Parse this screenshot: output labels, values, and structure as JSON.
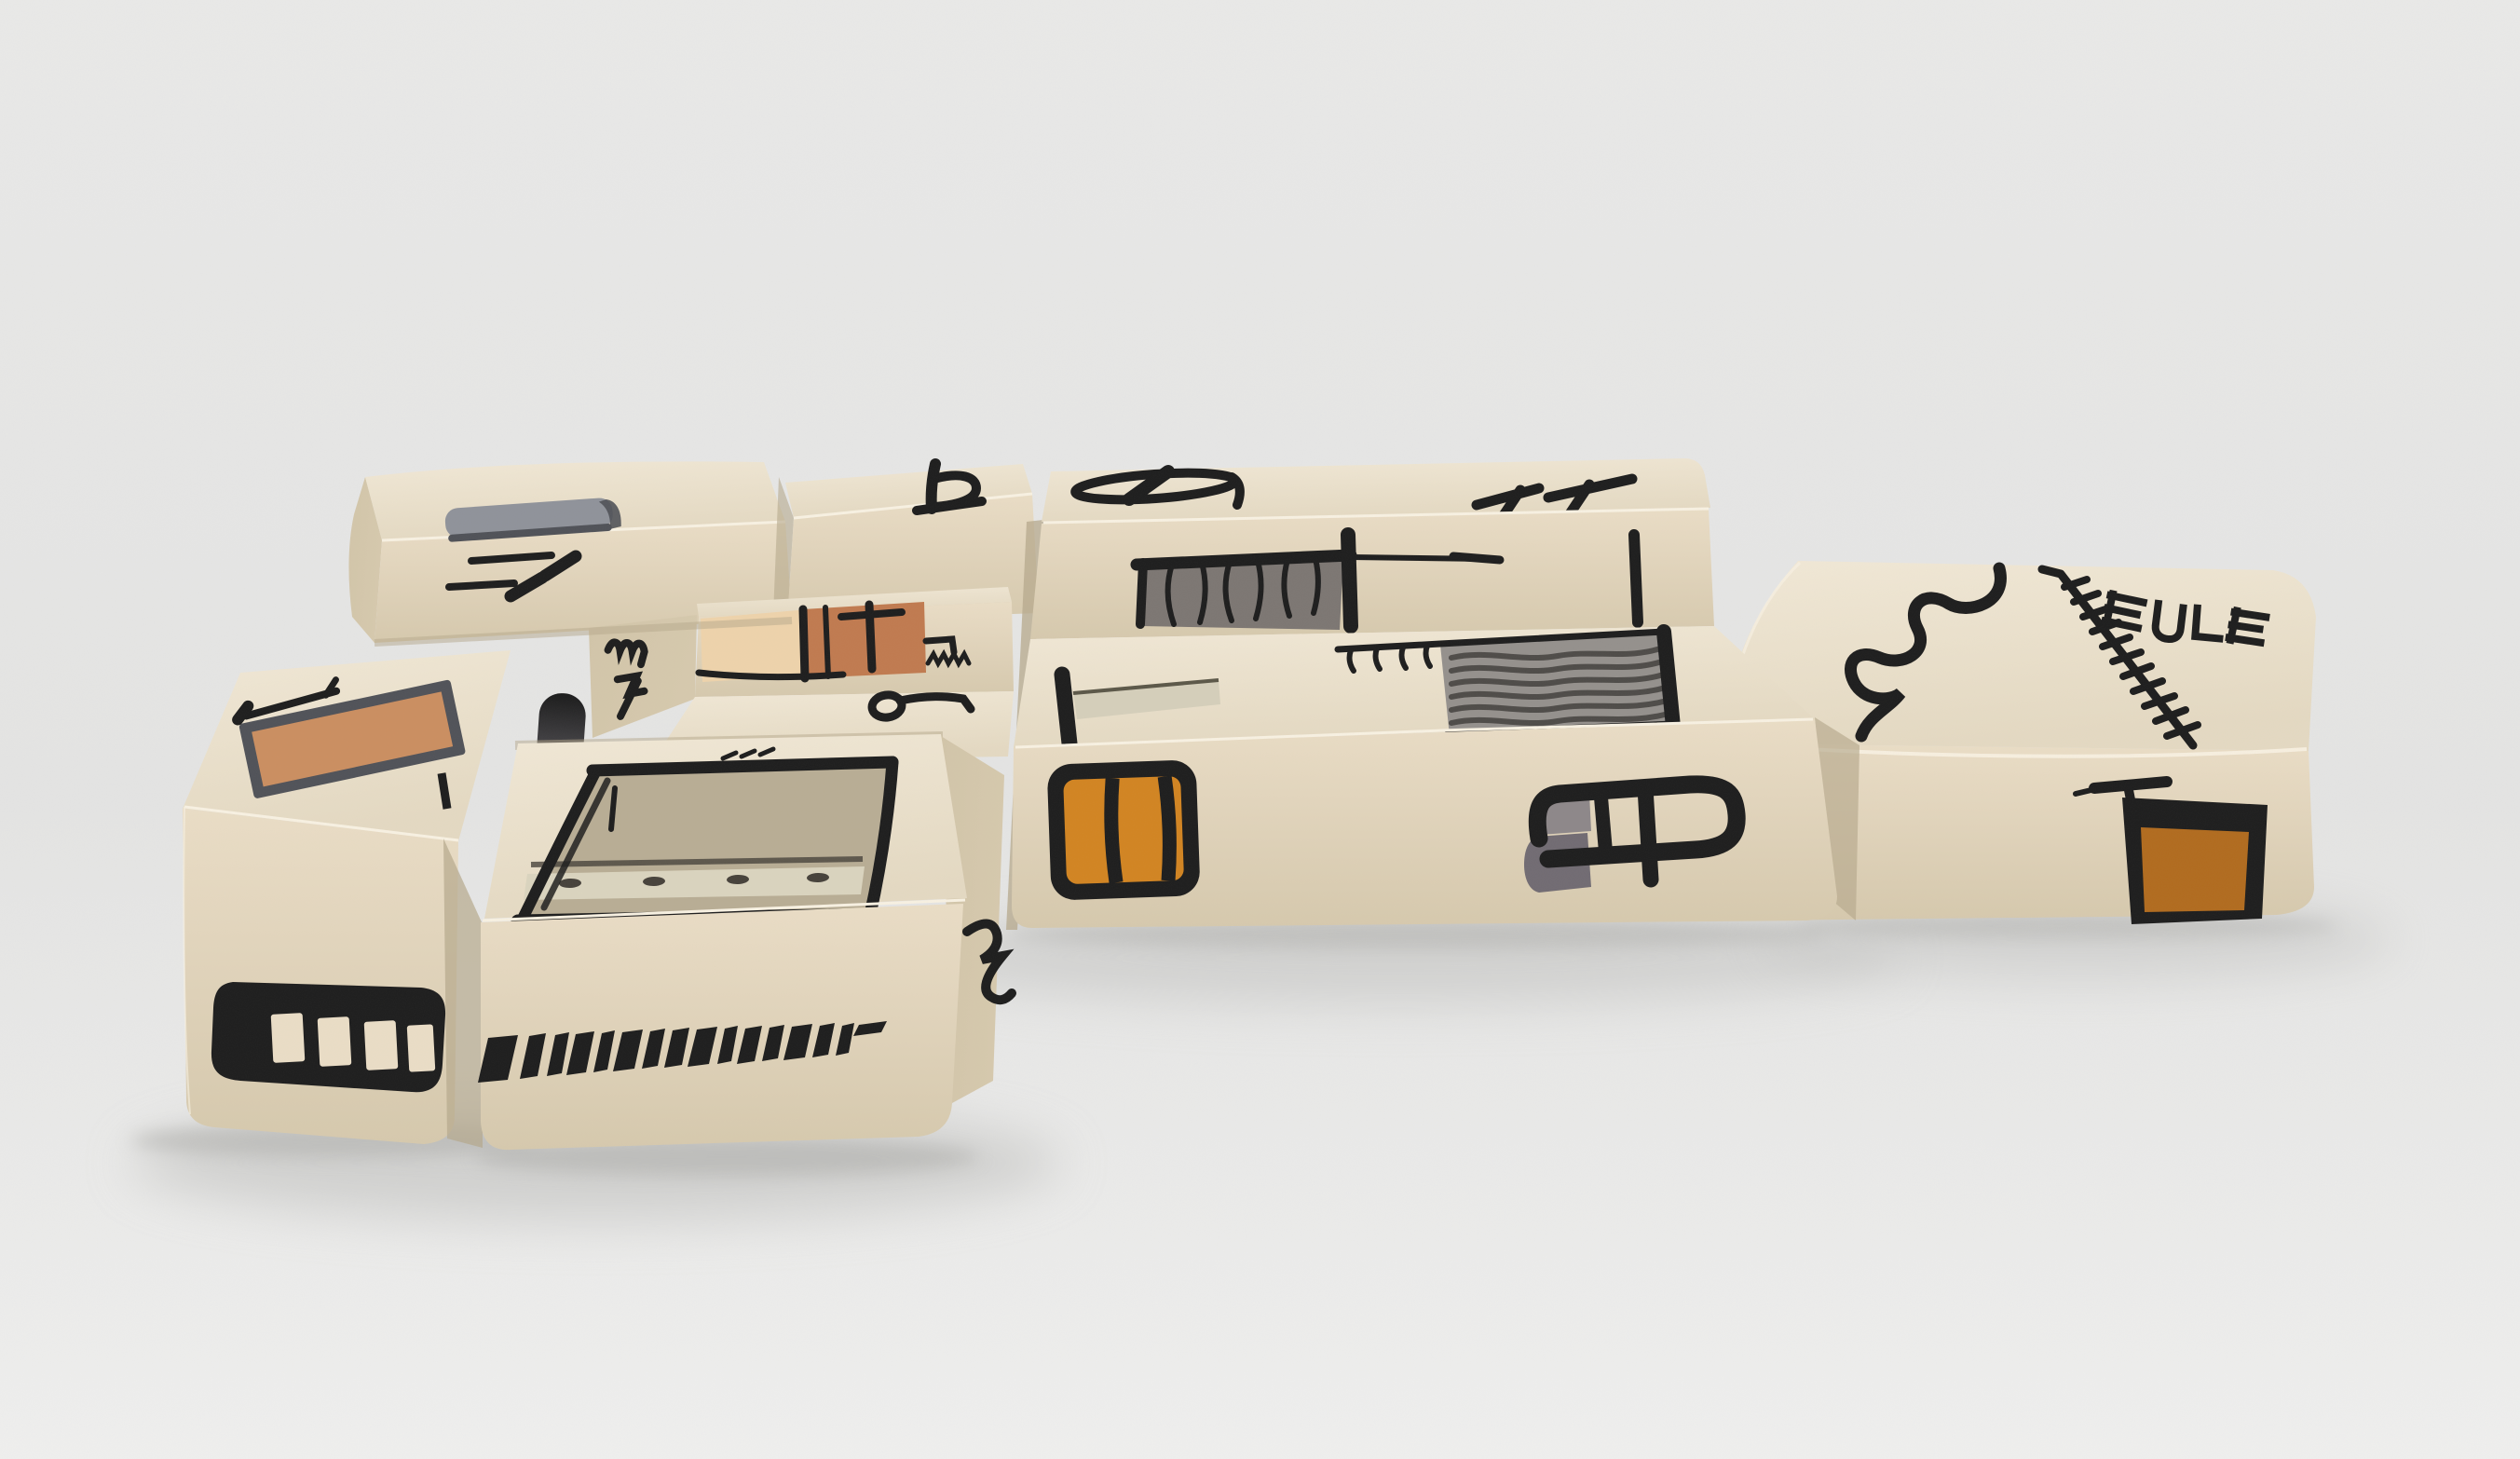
{
  "scene": {
    "description": "Studio product photo of a cream modular fabric sofa printed with abstract black, gray, orange and terracotta doodle motifs, on a plain light gray background",
    "caption": ""
  },
  "palette": {
    "background_top": "#e9e9e8",
    "background": "#e4e4e3",
    "floor_light": "#efefee",
    "shadow_soft": "#bdbdbb",
    "shadow_contact": "#a9a9a6",
    "fabric_top": "#f1e8d6",
    "fabric_top_deep": "#e4d9c2",
    "fabric_front": "#eaddc6",
    "fabric_front_deep": "#d6c9ad",
    "fabric_shade": "#d2c5a9",
    "fabric_deep": "#b5a88c",
    "piping": "#f8f1e2",
    "ink": "#1d1d1d",
    "band_gray": "#8f929a",
    "band_gray_dark": "#4f5157",
    "curtain_gray": "#7c7672",
    "woven_gray": "#94908c",
    "woven_line": "#4e4b48",
    "taupe": "#b8ad94",
    "taupe_band": "#dad4be",
    "taupe_line": "#46413a",
    "beige_bar": "#d5cfba",
    "beige_bar_edge": "#5b5748",
    "orange": "#d28421",
    "pocket_orange": "#b16b1e",
    "tan_patch": "#cb8e60",
    "tan_frame": "#505258",
    "terracotta": "#c07a4f",
    "peach": "#eed3ab",
    "glyph_gray": "#8d8789",
    "glyph_gray_dark": "#716b72",
    "zip_dark": "#1a1a1a",
    "zip_light": "#76737a"
  },
  "sofa": {
    "modules": [
      {
        "id": "left-arm-bench",
        "motifs": [
          "tan-framed-patch",
          "hammer-glyph",
          "film-strip",
          "edge-tick"
        ]
      },
      {
        "id": "left-backrest",
        "motifs": [
          "gray-wrap-band",
          "check-strokes",
          "zip-bar"
        ]
      },
      {
        "id": "corner-backrest",
        "motifs": [
          "blackletter-b-glyph"
        ]
      },
      {
        "id": "corner-seat",
        "motifs": [
          "peach-band",
          "terracotta-panel-with-cross",
          "zigzag-stitches",
          "loop-nine-glyph",
          "m4-glyph"
        ]
      },
      {
        "id": "chaise-ottoman",
        "motifs": [
          "sketched-frame-rectangle",
          "stitch-dots",
          "slash-stitches",
          "numeral-two-glyph",
          "hatch-dash-stripe"
        ]
      },
      {
        "id": "right-seat",
        "motifs": [
          "phi-glyph",
          "double-seven-glyph",
          "curtain-panel",
          "long-rule-line",
          "vertical-bar",
          "claw-stitches",
          "woven-panel",
          "axe-bar",
          "striped-barrel",
          "double-p-monogram"
        ]
      },
      {
        "id": "right-ottoman",
        "motifs": [
          "meander-line",
          "hatched-wand",
          "letterform-stack",
          "tee-glyph",
          "orange-pocket"
        ]
      }
    ]
  }
}
